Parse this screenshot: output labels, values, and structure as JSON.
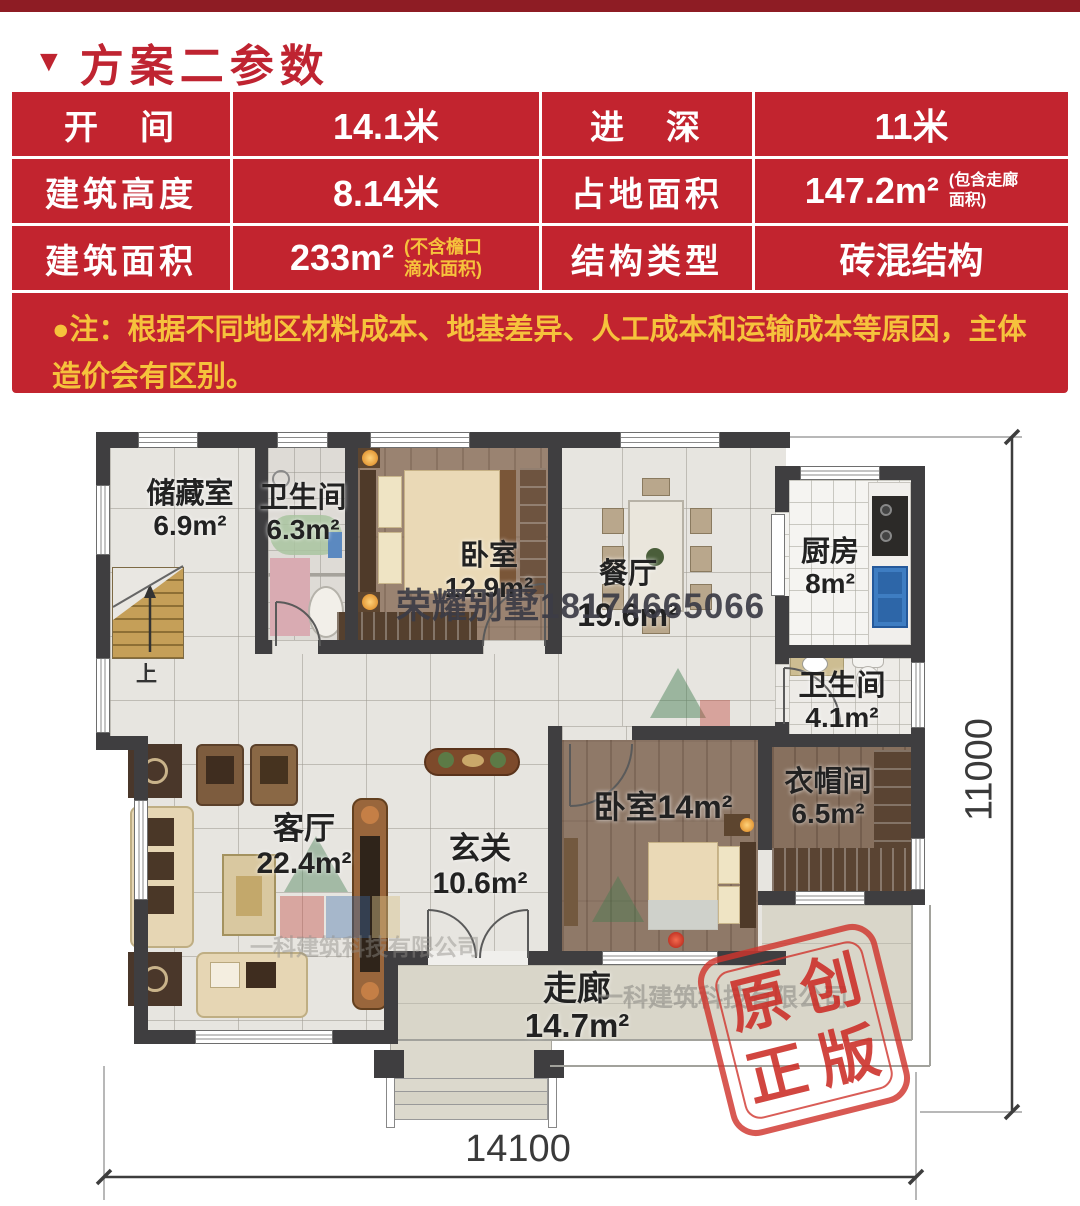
{
  "meta": {
    "accent_red": "#bf2431",
    "table_red": "#c2242f",
    "note_yellow": "#f6c23c",
    "stamp_red": "#cf342d",
    "wall_color": "#3f3e40"
  },
  "header": {
    "marker": "▼",
    "title": "方案二参数"
  },
  "spec_table": {
    "rows": [
      {
        "c1": "开　间",
        "c2": "14.1米",
        "c3": "进　深",
        "c4": "11米"
      },
      {
        "c1": "建筑高度",
        "c2": "8.14米",
        "c3": "占地面积",
        "c4": "147.2m²",
        "c4_note1": "(包含走廊",
        "c4_note2": "面积)"
      },
      {
        "c1": "建筑面积",
        "c2": "233m²",
        "c2_note1": "(不含檐口",
        "c2_note2": "滴水面积)",
        "c3": "结构类型",
        "c4": "砖混结构"
      }
    ]
  },
  "note": {
    "line1": "●注：根据不同地区材料成本、地基差异、人工成本和运输成本等原因，主体",
    "line2": "造价会有区别。"
  },
  "floor_plan": {
    "rooms": {
      "storage": {
        "name": "储藏室",
        "area": "6.9m²"
      },
      "bath_upper": {
        "name": "卫生间",
        "area": "6.3m²"
      },
      "bedroom_upper": {
        "name": "卧室",
        "area": "12.9m²"
      },
      "dining": {
        "name": "餐厅",
        "area": "19.6m²"
      },
      "kitchen": {
        "name": "厨房",
        "area": "8m²"
      },
      "bath_lower": {
        "name": "卫生间",
        "area": "4.1m²"
      },
      "cloakroom": {
        "name": "衣帽间",
        "area": "6.5m²"
      },
      "bedroom_lower": {
        "name": "卧室",
        "area": "14m²"
      },
      "foyer": {
        "name": "玄关",
        "area": "10.6m²"
      },
      "living": {
        "name": "客厅",
        "area": "22.4m²"
      },
      "corridor": {
        "name": "走廊",
        "area": "14.7m²"
      }
    },
    "stair_up_label": "上",
    "dimensions": {
      "width_mm": "14100",
      "depth_mm": "11000"
    },
    "watermarks": {
      "phone": "荣耀别墅18174665066",
      "company": "一科建筑科技有限公司"
    },
    "stamp": {
      "line1": "原创",
      "line2": "正版"
    }
  }
}
